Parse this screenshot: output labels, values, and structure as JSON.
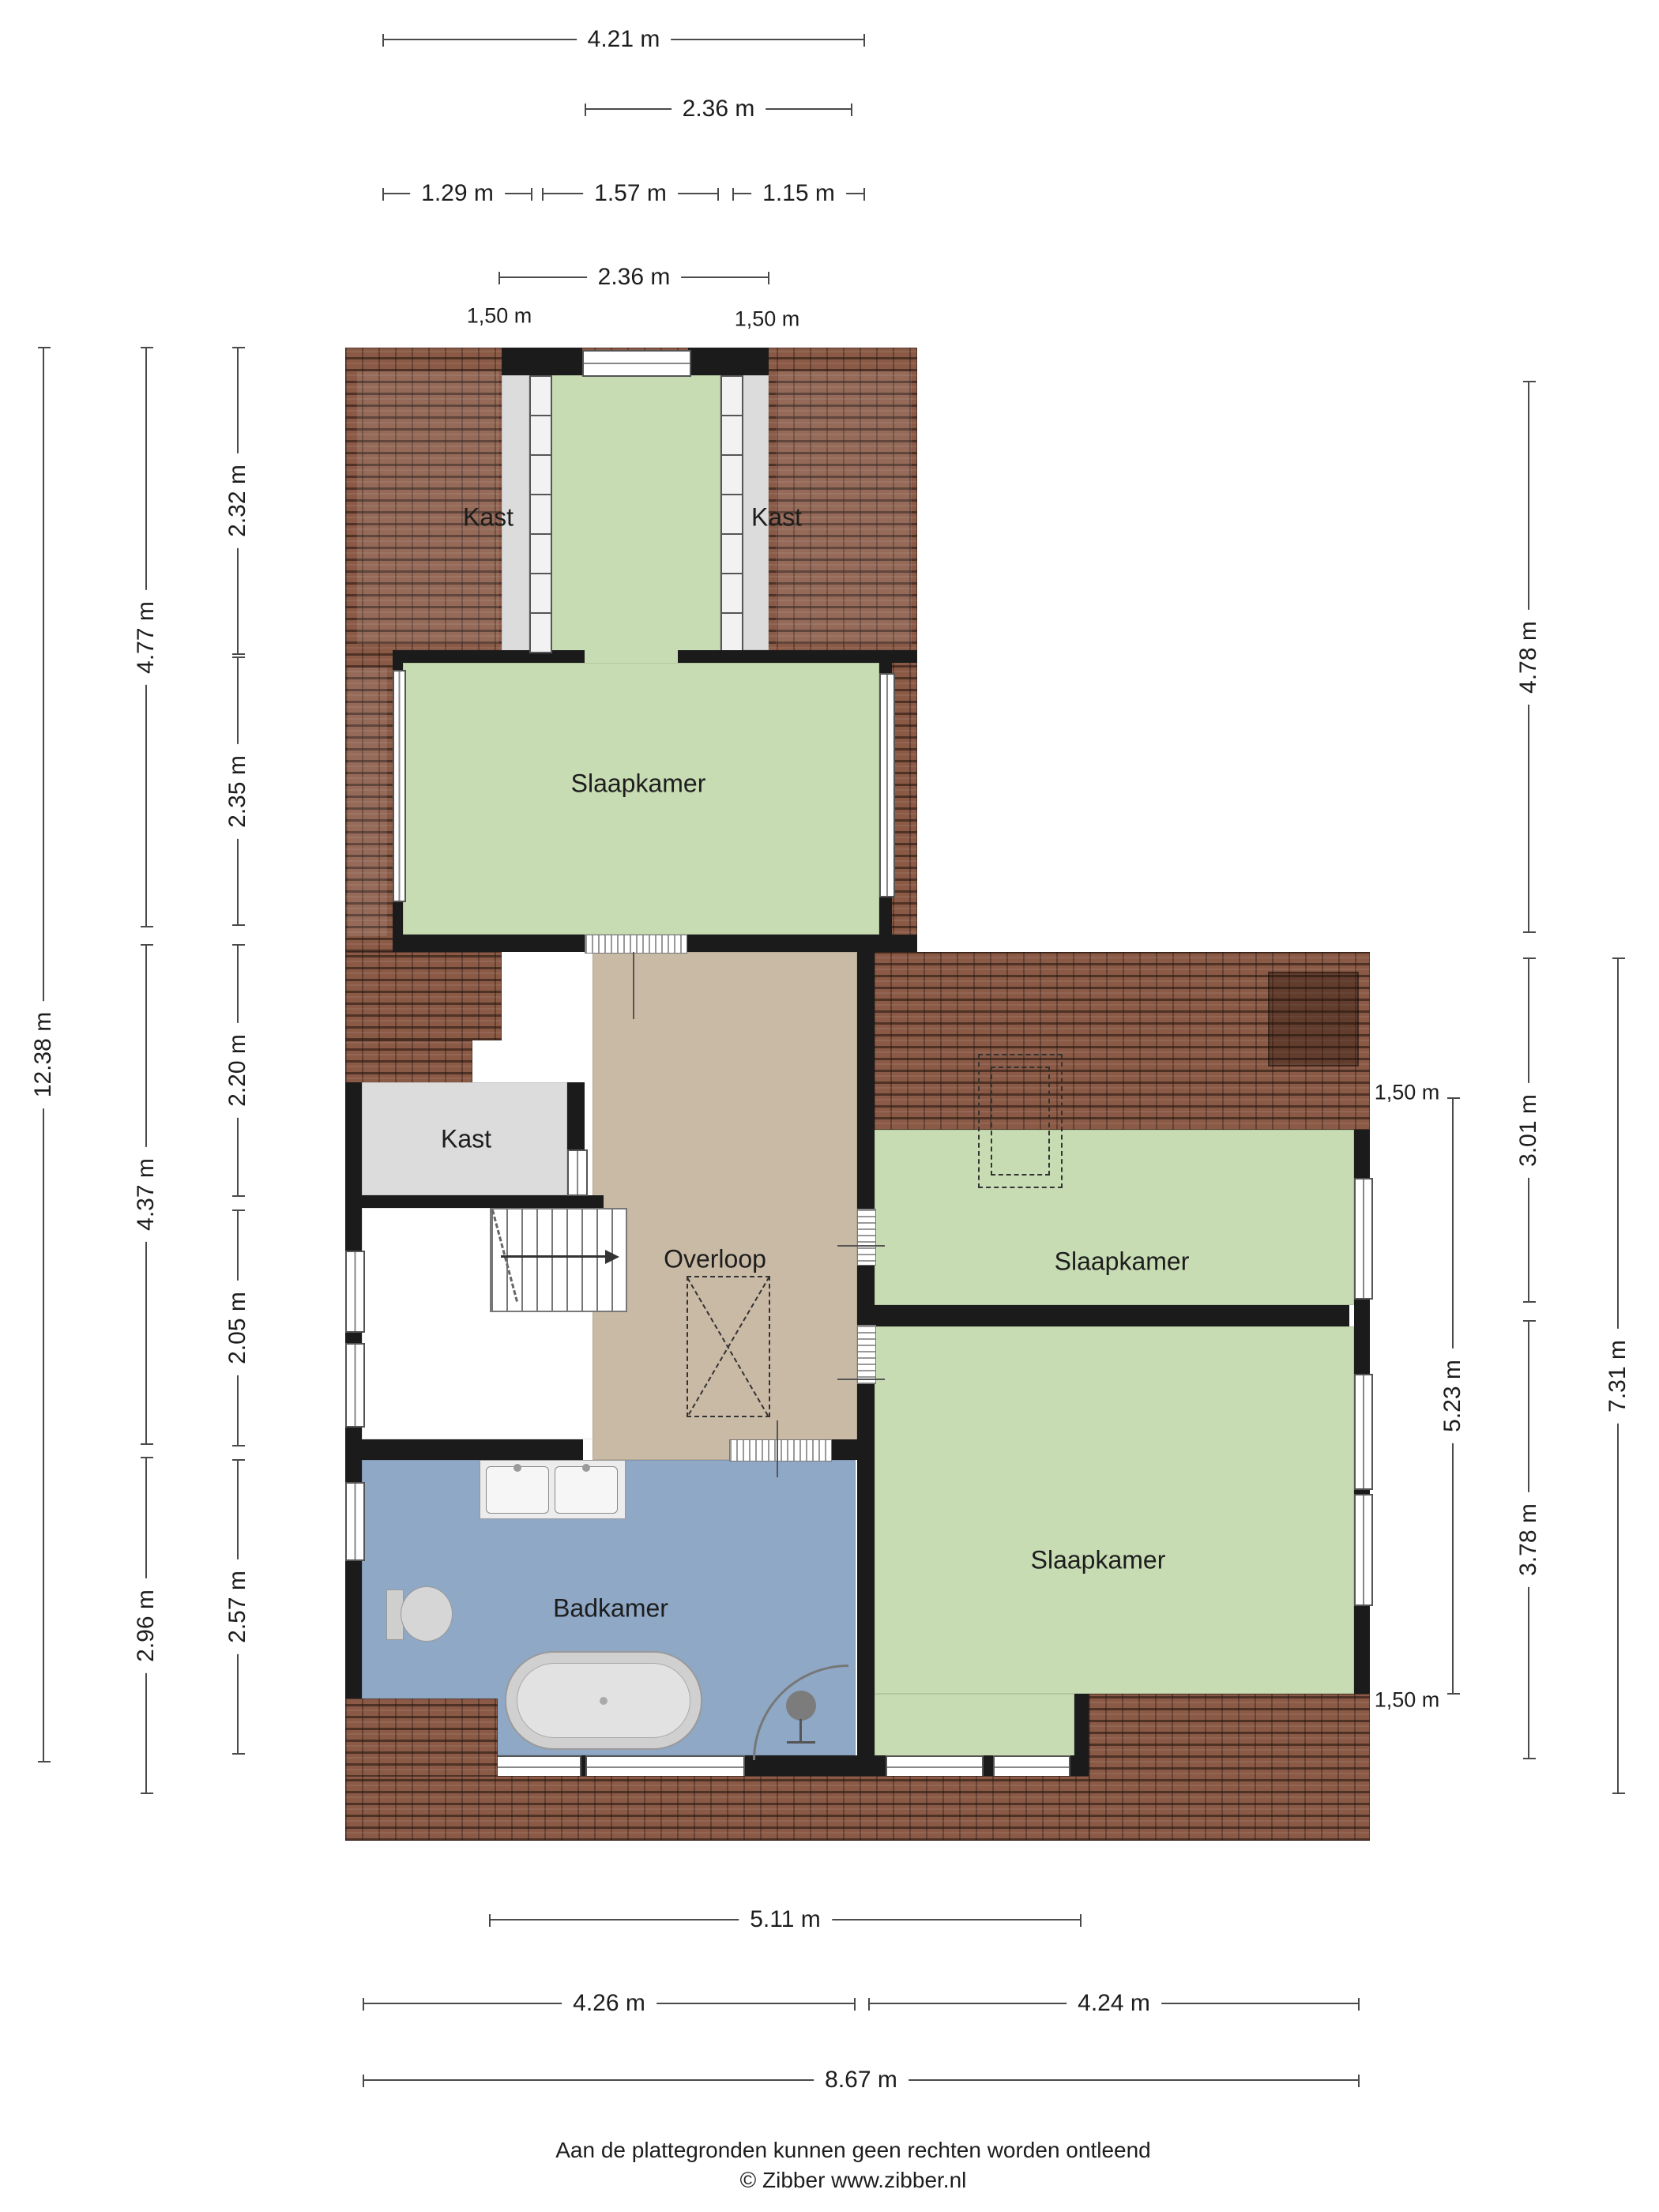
{
  "rooms": {
    "kast_top_left": "Kast",
    "kast_top_right": "Kast",
    "slaapkamer_top": "Slaapkamer",
    "kast_middle": "Kast",
    "overloop": "Overloop",
    "slaapkamer_right_upper": "Slaapkamer",
    "slaapkamer_right_lower": "Slaapkamer",
    "badkamer": "Badkamer"
  },
  "dims": {
    "top": [
      "4.21 m",
      "2.36 m",
      "1.29 m",
      "1.57 m",
      "1.15 m",
      "2.36 m"
    ],
    "top_markers": [
      "1,50 m",
      "1,50 m"
    ],
    "left": [
      "12.38 m",
      "4.77 m",
      "4.37 m",
      "2.96 m",
      "2.32 m",
      "2.35 m",
      "2.20 m",
      "2.05 m",
      "2.57 m"
    ],
    "right": [
      "4.78 m",
      "3.01 m",
      "3.78 m",
      "5.23 m",
      "7.31 m"
    ],
    "right_markers": [
      "1,50 m",
      "1,50 m"
    ],
    "bottom": [
      "5.11 m",
      "4.26 m",
      "4.24 m",
      "8.67 m"
    ]
  },
  "footer": {
    "disclaimer": "Aan de plattegronden kunnen geen rechten worden ontleend",
    "copyright": "© Zibber www.zibber.nl"
  },
  "colors": {
    "roof_brown": "#8a5a46",
    "room_green": "#c8dcb4",
    "room_gray": "#dcdcdc",
    "hall_tan": "#c9baa5",
    "bath_blue": "#8ea8c6",
    "wall_black": "#1b1b1b",
    "dim_line": "#4a4a4a"
  }
}
